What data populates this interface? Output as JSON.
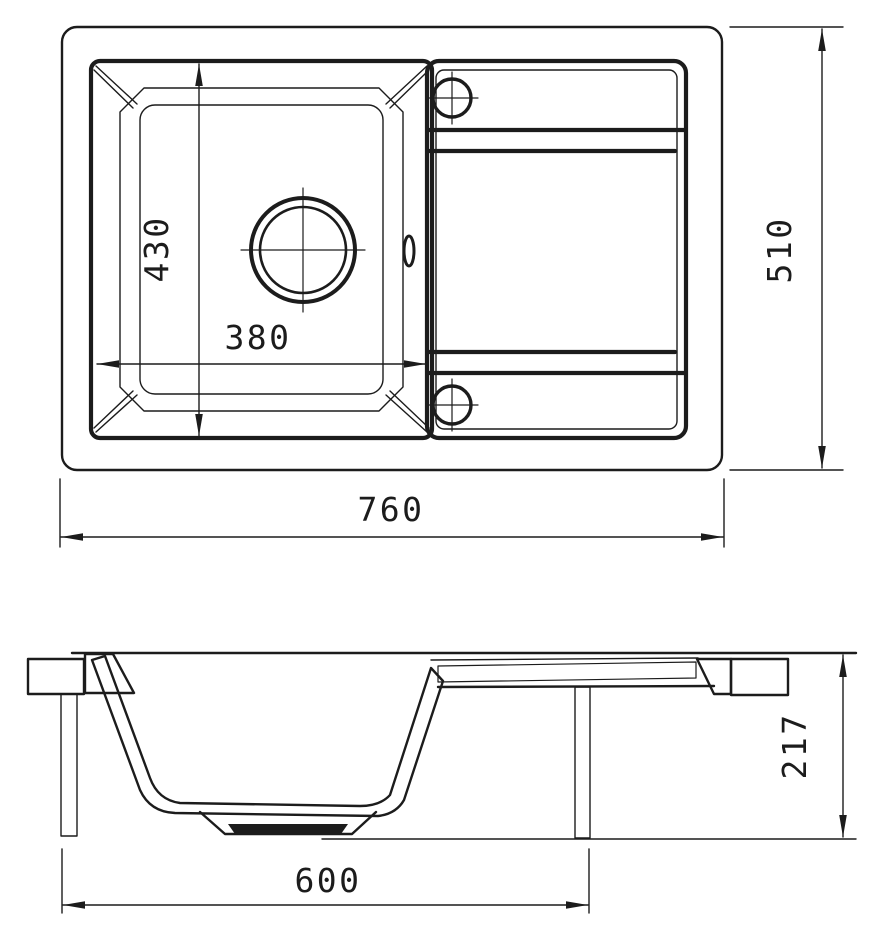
{
  "drawing": {
    "title": "sink-technical-drawing",
    "background": "#ffffff",
    "line_color": "#1c1c1c",
    "views": {
      "top_view": "plan-view-of-sink",
      "section_view": "side-section-view-of-sink"
    }
  },
  "dimensions": {
    "basin_depth": "430",
    "basin_width": "380",
    "overall_width": "510",
    "overall_length": "760",
    "base_length": "600",
    "overall_height": "217"
  }
}
